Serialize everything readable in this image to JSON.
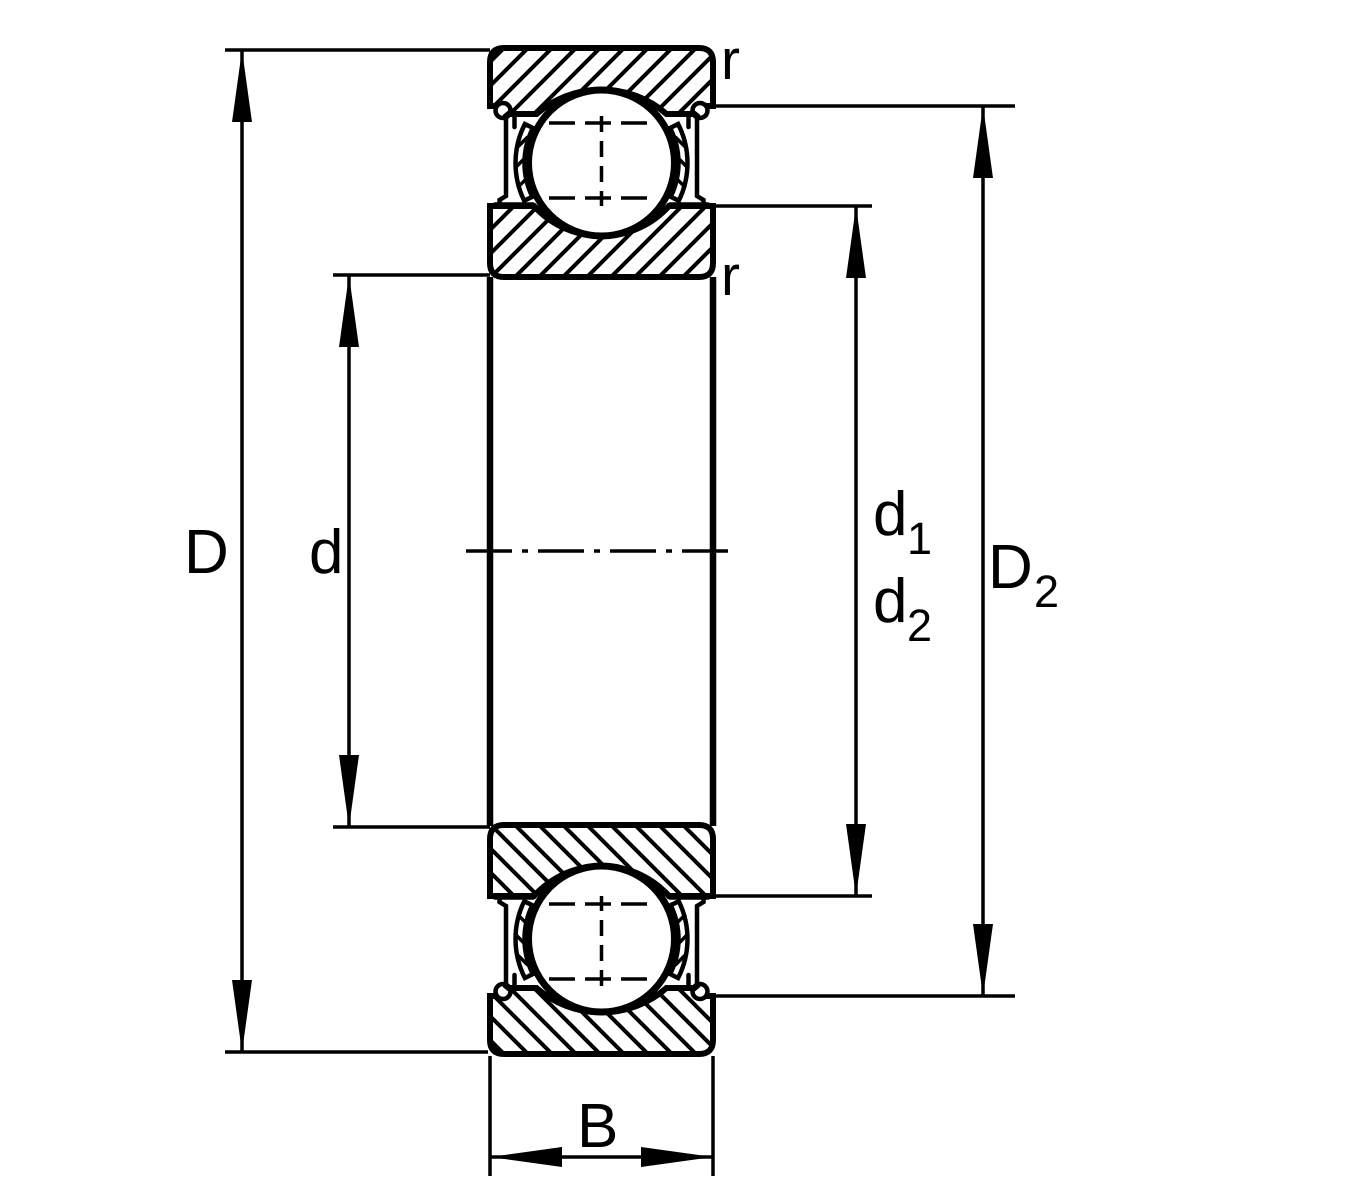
{
  "labels": {
    "D": "D",
    "d": "d",
    "d1": {
      "base": "d",
      "sub": "1"
    },
    "d2": {
      "base": "d",
      "sub": "2"
    },
    "D2": {
      "base": "D",
      "sub": "2"
    },
    "B": "B",
    "r_top": "r",
    "r_bottom": "r"
  },
  "colors": {
    "ink": "#000000",
    "background": "#ffffff"
  }
}
